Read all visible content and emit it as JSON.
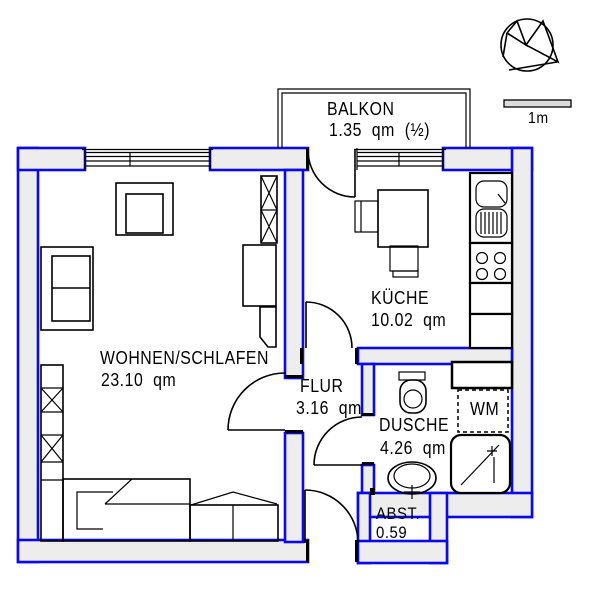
{
  "rooms": {
    "balkon": {
      "name": "BALKON",
      "area": "1.35  qm  (½)"
    },
    "kueche": {
      "name": "KÜCHE",
      "area": "10.02  qm"
    },
    "wohnen": {
      "name": "WOHNEN/SCHLAFEN",
      "area": "23.10  qm"
    },
    "flur": {
      "name": "FLUR",
      "area": "3.16  qm"
    },
    "dusche": {
      "name": "DUSCHE",
      "area": "4.26  qm"
    },
    "abstellraum": {
      "name": "ABST.",
      "area": "0.59"
    }
  },
  "labels": {
    "washing_machine": "WM",
    "scale": "1m"
  },
  "icons": {
    "north_arrow": "north-arrow-icon"
  },
  "colors": {
    "wall_outline": "#0a0ae8",
    "wall_fill": "#ededed",
    "line": "#000000",
    "background": "#ffffff"
  }
}
